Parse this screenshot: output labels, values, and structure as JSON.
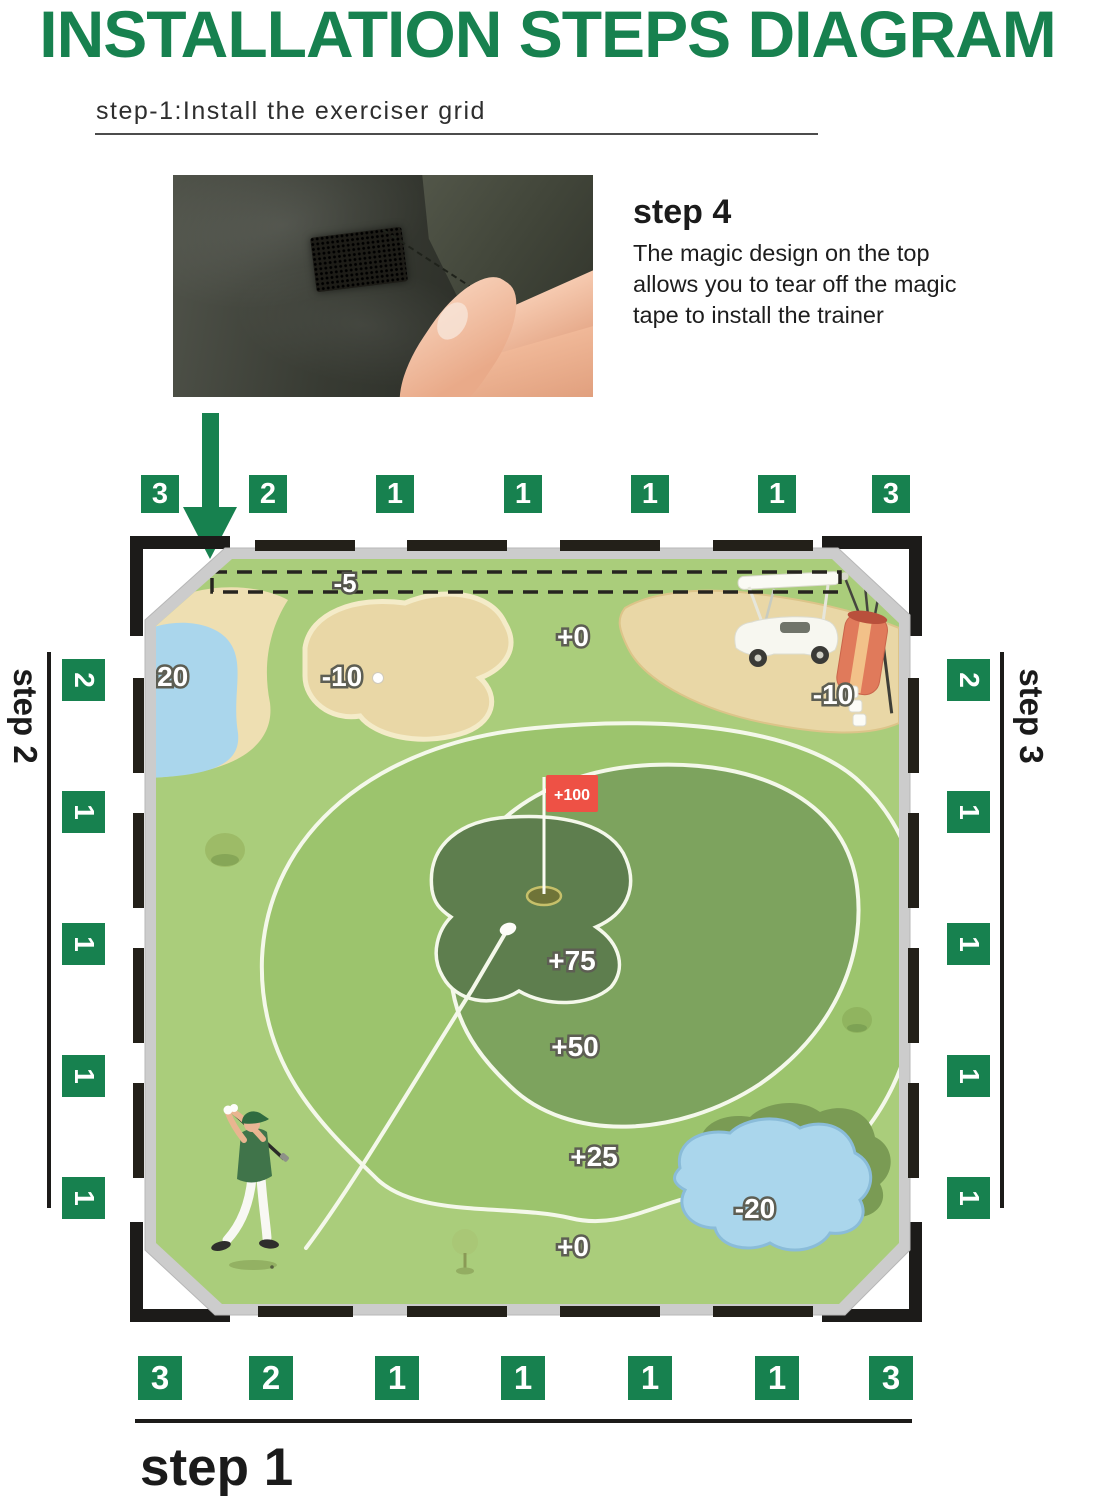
{
  "title": "INSTALLATION STEPS DIAGRAM",
  "caption": {
    "text": "step-1:Install the exerciser grid"
  },
  "step4": {
    "heading": "step 4",
    "description": "The magic design on the top allows you to tear off the magic tape to install the trainer"
  },
  "step_labels": {
    "bottom": "step 1",
    "left": "step 2",
    "right": "step 3"
  },
  "tabs": {
    "top": [
      "3",
      "2",
      "1",
      "1",
      "1",
      "1",
      "3"
    ],
    "bottom": [
      "3",
      "2",
      "1",
      "1",
      "1",
      "1",
      "3"
    ],
    "left": [
      "2",
      "1",
      "1",
      "1",
      "1"
    ],
    "right": [
      "2",
      "1",
      "1",
      "1",
      "1"
    ]
  },
  "mat": {
    "zones": {
      "top_strip": "-5",
      "water_left": "-20",
      "bunker": "-10",
      "fairway_top": "+0",
      "rough_right": "-10",
      "flag": "+100",
      "green": "+75",
      "mid": "+50",
      "ring": "+25",
      "fairway_bottom": "+0",
      "water_right": "-20"
    }
  },
  "colors": {
    "accent_green": "#17814f",
    "tab_green": "#17814f",
    "flag_red": "#ee5145",
    "frame_black": "#1c1b19",
    "mat_border_gray": "#cccccc",
    "zone0": "#aacd7b",
    "zone25": "#9cc46d",
    "zone50": "#7da35e",
    "zone75": "#5e7e4e",
    "water_blue": "#aad6ec",
    "sand_tan": "#e9d7a6",
    "line_white": "#f4f8ea"
  }
}
